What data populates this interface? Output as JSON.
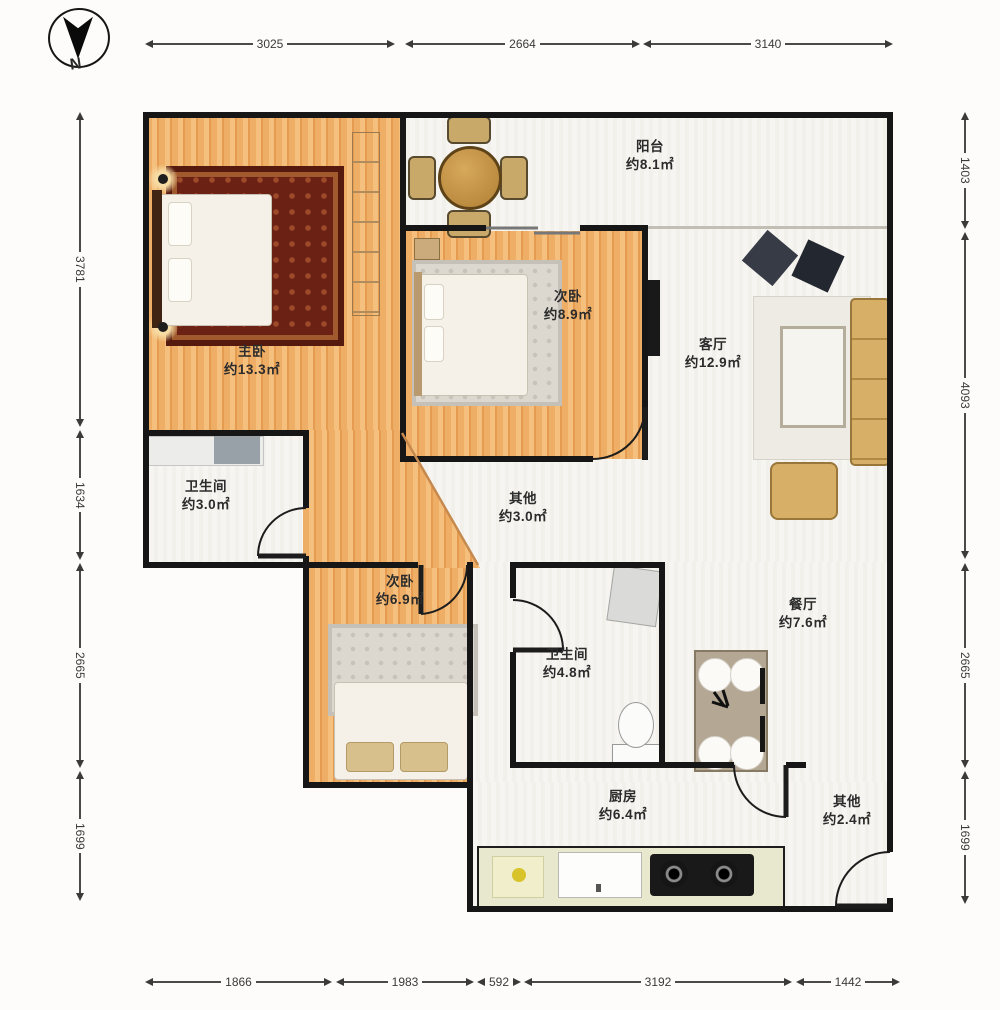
{
  "compass": {
    "label": "N"
  },
  "rooms": {
    "balcony": {
      "name": "阳台",
      "area": "约8.1㎡"
    },
    "master": {
      "name": "主卧",
      "area": "约13.3㎡"
    },
    "bedroom2": {
      "name": "次卧",
      "area": "约8.9㎡"
    },
    "living": {
      "name": "客厅",
      "area": "约12.9㎡"
    },
    "bath1": {
      "name": "卫生间",
      "area": "约3.0㎡"
    },
    "other1": {
      "name": "其他",
      "area": "约3.0㎡"
    },
    "bedroom3": {
      "name": "次卧",
      "area": "约6.9㎡"
    },
    "bath2": {
      "name": "卫生间",
      "area": "约4.8㎡"
    },
    "dining": {
      "name": "餐厅",
      "area": "约7.6㎡"
    },
    "kitchen": {
      "name": "厨房",
      "area": "约6.4㎡"
    },
    "other2": {
      "name": "其他",
      "area": "约2.4㎡"
    }
  },
  "dimensions": {
    "top": [
      "3025",
      "2664",
      "3140"
    ],
    "bottom": [
      "1866",
      "1983",
      "592",
      "3192",
      "1442"
    ],
    "left": [
      "3781",
      "1634",
      "2665",
      "1699"
    ],
    "right": [
      "1403",
      "4093",
      "2665",
      "1699"
    ]
  },
  "colors": {
    "wall": "#161616",
    "wood_floor": "#eeae66",
    "light_floor": "#f6f5f1",
    "sofa_tan": "#d8af66",
    "rug_red": "#6b2114"
  }
}
